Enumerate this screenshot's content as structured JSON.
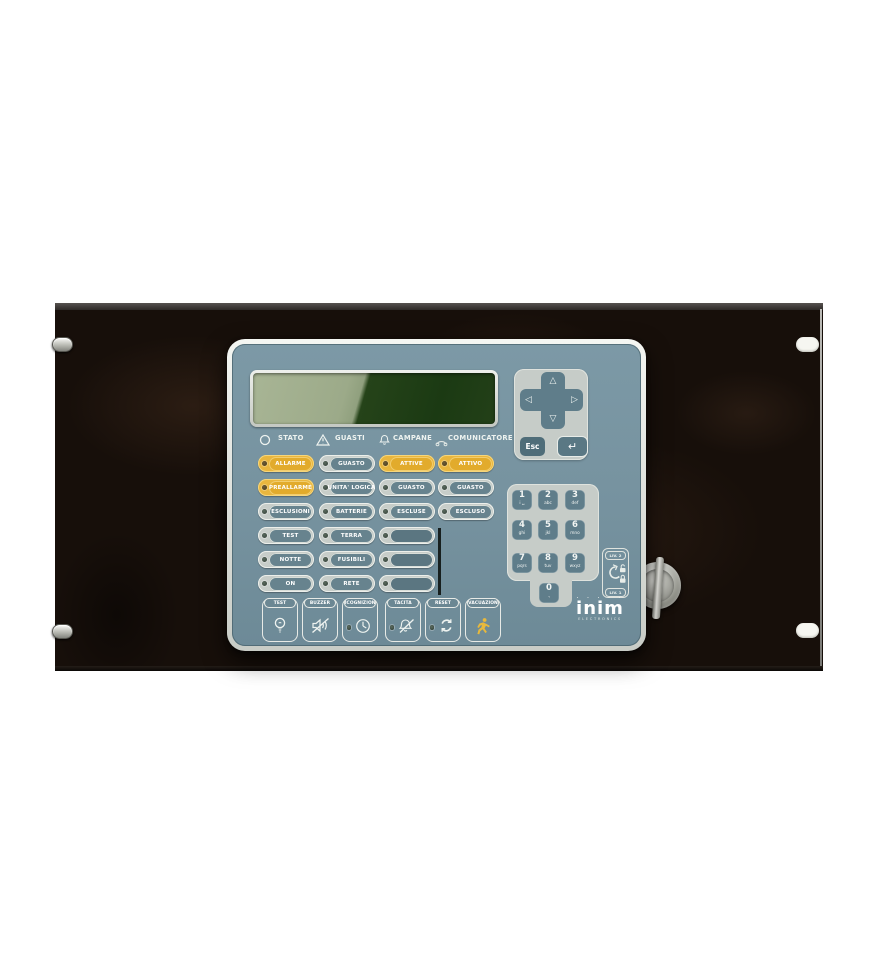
{
  "device": {
    "brand": "inim",
    "brand_sub": "ELECTRONICS",
    "brand_dots": "· · · · ·"
  },
  "status_columns": [
    {
      "header": "STATO"
    },
    {
      "header": "GUASTI"
    },
    {
      "header": "CAMPANE"
    },
    {
      "header": "COMUNICATORE"
    }
  ],
  "led_buttons": {
    "stato": [
      "ALLARME",
      "PREALLARME",
      "ESCLUSIONI",
      "TEST",
      "NOTTE",
      "ON"
    ],
    "guasti": [
      "GUASTO",
      "UNITA' LOGICA",
      "BATTERIE",
      "TERRA",
      "FUSIBILI",
      "RETE"
    ],
    "campane": [
      "ATTIVE",
      "GUASTO",
      "ESCLUSE"
    ],
    "comunicatore": [
      "ATTIVO",
      "GUASTO",
      "ESCLUSO"
    ]
  },
  "action_buttons": [
    {
      "label": "TEST"
    },
    {
      "label": "BUZZER"
    },
    {
      "label": "RICOGNIZIONE"
    },
    {
      "label": "TACITA"
    },
    {
      "label": "RESET"
    },
    {
      "label": "EVACUAZIONE"
    }
  ],
  "nav": {
    "esc": "Esc",
    "enter": "↵",
    "up": "△",
    "down": "▽",
    "left": "◁",
    "right": "▷"
  },
  "keypad": [
    {
      "digit": "1",
      "sub": "i ␣"
    },
    {
      "digit": "2",
      "sub": "abc"
    },
    {
      "digit": "3",
      "sub": "def"
    },
    {
      "digit": "4",
      "sub": "ghi"
    },
    {
      "digit": "5",
      "sub": "jkl"
    },
    {
      "digit": "6",
      "sub": "mno"
    },
    {
      "digit": "7",
      "sub": "pqrs"
    },
    {
      "digit": "8",
      "sub": "tuv"
    },
    {
      "digit": "9",
      "sub": "wxyz"
    },
    {
      "digit": "0",
      "sub": ".,"
    }
  ],
  "key_levels": {
    "top": "LIV. 2",
    "bottom": "LIV. 1"
  },
  "colors": {
    "panel_face": "#76929f",
    "button_yellow": "#e9b63e",
    "capsule_gray": "#c7cdc9",
    "pill_slate": "#67838e",
    "lcd_light": "#a8b595",
    "lcd_dark": "#1b3a13",
    "rack": "#170f0a"
  }
}
